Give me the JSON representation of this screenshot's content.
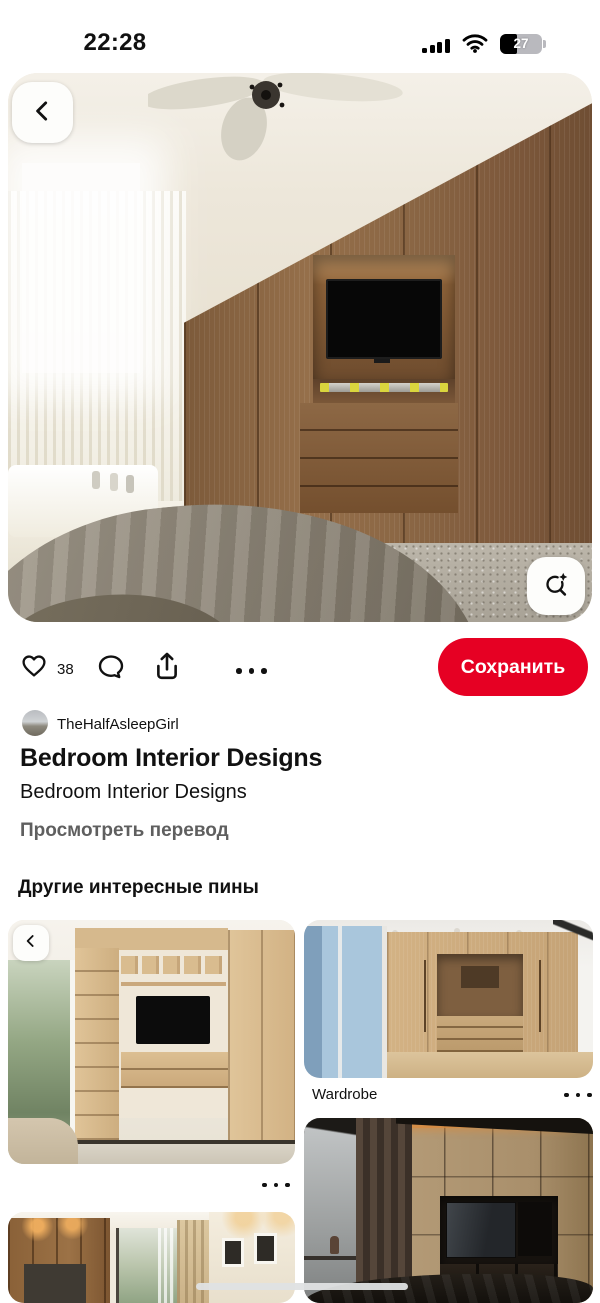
{
  "status_bar": {
    "time": "22:28",
    "battery_percent": "27"
  },
  "pin_viewer": {
    "like_count": "38",
    "save_label": "Сохранить"
  },
  "author": {
    "name": "TheHalfAsleepGirl"
  },
  "pin_info": {
    "title": "Bedroom Interior Designs",
    "description": "Bedroom Interior Designs",
    "translate_label": "Просмотреть перевод"
  },
  "related": {
    "header": "Другие интересные пины",
    "pins": [
      {
        "label": "",
        "image_alt": "light oak TV wall unit living room"
      },
      {
        "label": "Wardrobe",
        "image_alt": "light wood wardrobe with niche"
      },
      {
        "label": "",
        "image_alt": "dark bedroom with TV wall panel"
      },
      {
        "label": "",
        "image_alt": "bedroom corridor with wardrobe and window"
      }
    ]
  },
  "main_image_alt": "bedroom with wooden wardrobe wall, TV niche, ceiling fan, sheer curtains and bed",
  "icons": {
    "back": "chevron-left",
    "lens": "visual-search-with-sparkle",
    "like": "heart-outline",
    "comment": "speech-bubble",
    "share": "arrow-up-from-tray",
    "more": "three-dots",
    "cellular": "signal-bars-4",
    "wifi": "wifi-arcs"
  },
  "colors": {
    "accent": "#e60023",
    "text": "#111111",
    "muted": "#5f5f5f"
  }
}
